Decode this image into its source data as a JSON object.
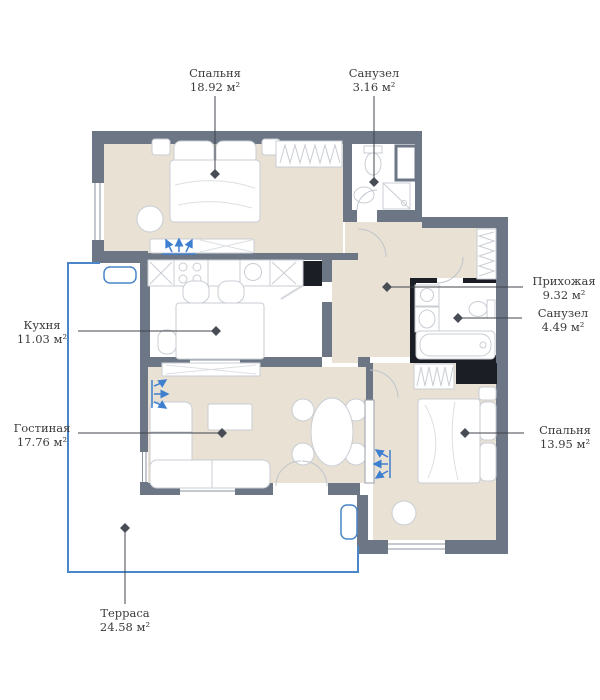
{
  "palette": {
    "wall": "#6c7684",
    "wallDark": "#1b1e24",
    "floor": "#e8e1d4",
    "blue": "#4a86c8",
    "ink": "#40444d",
    "furn": "#c9cdd3",
    "frame": "#8a93a0",
    "text": "#3c3c3c",
    "bg": "#ffffff"
  },
  "rooms": [
    {
      "id": "bedroom-1",
      "name": "Спальня",
      "area": "18.92 м²"
    },
    {
      "id": "bathroom-1",
      "name": "Санузел",
      "area": "3.16 м²"
    },
    {
      "id": "hallway",
      "name": "Прихожая",
      "area": "9.32 м²"
    },
    {
      "id": "bathroom-2",
      "name": "Санузел",
      "area": "4.49 м²"
    },
    {
      "id": "kitchen",
      "name": "Кухня",
      "area": "11.03 м²"
    },
    {
      "id": "living-room",
      "name": "Гостиная",
      "area": "17.76 м²"
    },
    {
      "id": "bedroom-2",
      "name": "Спальня",
      "area": "13.95 м²"
    },
    {
      "id": "terrace",
      "name": "Терраса",
      "area": "24.58 м²"
    }
  ]
}
